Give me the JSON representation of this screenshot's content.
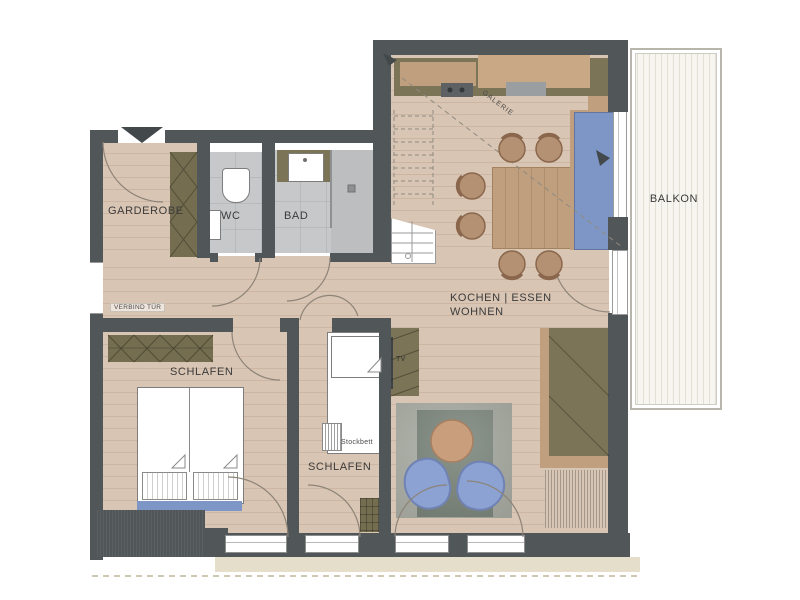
{
  "rooms": {
    "garderobe": {
      "label": "GARDEROBE"
    },
    "wc": {
      "label": "WC"
    },
    "bad": {
      "label": "BAD"
    },
    "living": {
      "label_line1": "KOCHEN | ESSEN",
      "label_line2": "WOHNEN"
    },
    "balcony": {
      "label": "BALKON"
    },
    "bedroom_main": {
      "label": "SCHLAFEN"
    },
    "bedroom_kids": {
      "label": "SCHLAFEN"
    }
  },
  "annotations": {
    "connecting_door": "VERBIND TÜR",
    "gallery": "GALERIE",
    "bunk_bed": "Stockbett",
    "tv": "TV"
  },
  "colors": {
    "wall": "#515659",
    "wood_floor": "#d9c5b3",
    "tile_floor": "#c7c8ca",
    "furniture_olive": "#7b7457",
    "furniture_wood": "#bf9f7e",
    "accent_blue": "#7e96c6",
    "rug_gray": "#808a80",
    "balcony_deck": "#f7f5ef",
    "outside_apron": "#e4decb"
  }
}
